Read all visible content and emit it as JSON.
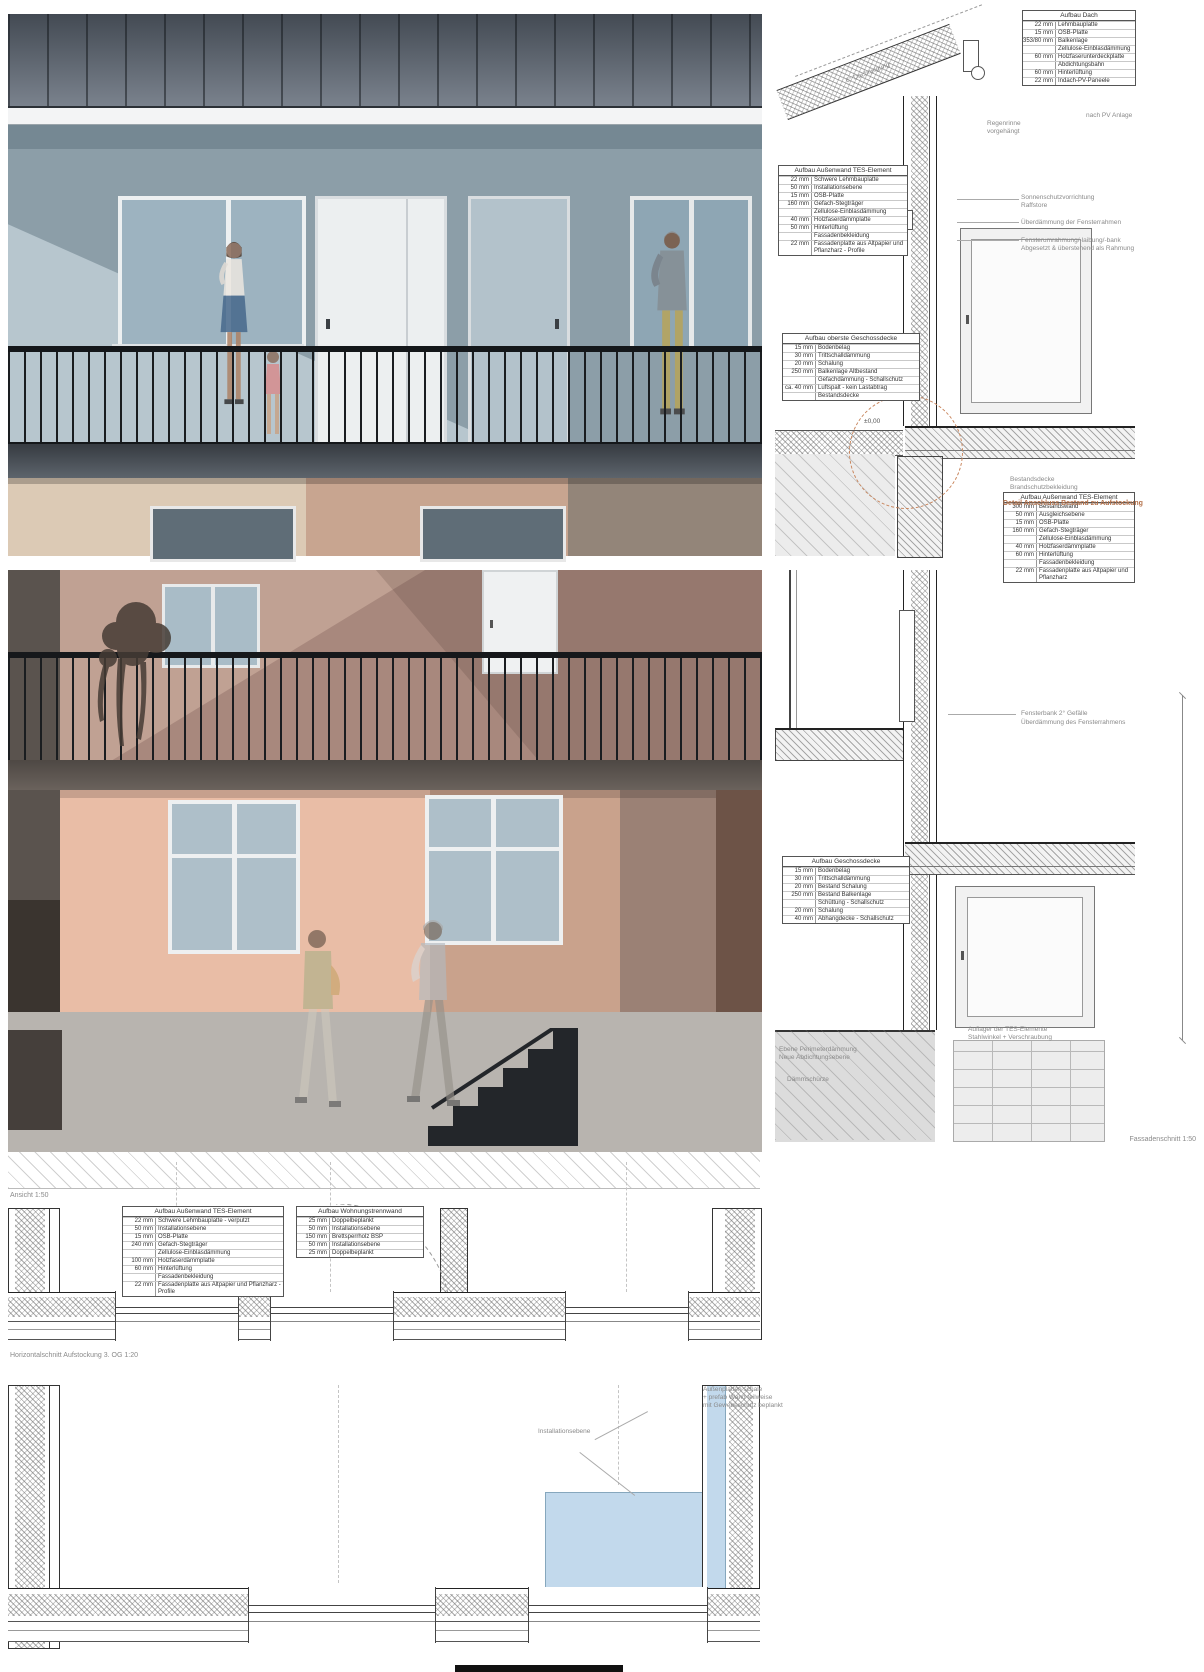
{
  "captions": {
    "ansicht": "Ansicht 1:50",
    "fassadenschnitt": "Fassadenschnitt 1:50",
    "horizontalschnitt": "Horizontalschnitt Aufstockung 3. OG 1:20"
  },
  "colors": {
    "accent_orange": "#c8855c",
    "plan_blue": "#c2d9ec",
    "facade_bluegrey": "#b7c6ce",
    "facade_mauve": "#a8887d",
    "facade_salmon": "#e9bda6"
  },
  "tables": {
    "dach": {
      "title": "Aufbau Dach",
      "rows": [
        [
          "22 mm",
          "Lehmbauplatte"
        ],
        [
          "15 mm",
          "OSB-Platte"
        ],
        [
          "353/80 mm",
          "Balkenlage"
        ],
        [
          "",
          "Zellulose-Einblasdämmung"
        ],
        [
          "60 mm",
          "Holzfaserunterdeckplatte"
        ],
        [
          "",
          "Abdichtungsbahn"
        ],
        [
          "60 mm",
          "Hinterlüftung"
        ],
        [
          "22 mm",
          "Indach-PV-Paneele"
        ]
      ]
    },
    "aussenwand_tes": {
      "title": "Aufbau Außenwand TES-Element",
      "rows": [
        [
          "22 mm",
          "Schwere Lehmbauplatte"
        ],
        [
          "50 mm",
          "Installationsebene"
        ],
        [
          "15 mm",
          "OSB-Platte"
        ],
        [
          "160 mm",
          "Gefach-Stegträger"
        ],
        [
          "",
          "Zellulose-Einblasdämmung"
        ],
        [
          "40 mm",
          "Holzfaserdämmplatte"
        ],
        [
          "50 mm",
          "Hinterlüftung"
        ],
        [
          "",
          "Fassadenbekleidung"
        ],
        [
          "22 mm",
          "Fassadenplatte aus Altpapier und Pflanzharz - Profile"
        ]
      ]
    },
    "oberste_decke": {
      "title": "Aufbau oberste Geschossdecke",
      "rows": [
        [
          "15 mm",
          "Bodenbelag"
        ],
        [
          "30 mm",
          "Trittschalldämmung"
        ],
        [
          "20 mm",
          "Schalung"
        ],
        [
          "250 mm",
          "Balkenlage Altbestand"
        ],
        [
          "",
          "Gefachdämmung - Schallschutz"
        ],
        [
          "ca. 40 mm",
          "Luftspalt - kein Lastabtrag"
        ],
        [
          "",
          "Bestandsdecke"
        ]
      ]
    },
    "aussenwand_bestand": {
      "title": "Aufbau Außenwand TES-Element",
      "rows": [
        [
          "300 mm",
          "Bestandswand"
        ],
        [
          "50 mm",
          "Ausgleichsebene"
        ],
        [
          "15 mm",
          "OSB-Platte"
        ],
        [
          "160 mm",
          "Gefach-Stegträger"
        ],
        [
          "",
          "Zellulose-Einblasdämmung"
        ],
        [
          "40 mm",
          "Holzfaserdämmplatte"
        ],
        [
          "60 mm",
          "Hinterlüftung"
        ],
        [
          "",
          "Fassadenbekleidung"
        ],
        [
          "22 mm",
          "Fassadenplatte aus Altpapier und Pflanzharz"
        ]
      ]
    },
    "geschossdecke": {
      "title": "Aufbau Geschossdecke",
      "rows": [
        [
          "15 mm",
          "Bodenbelag"
        ],
        [
          "30 mm",
          "Trittschalldämmung"
        ],
        [
          "20 mm",
          "Bestand Schalung"
        ],
        [
          "250 mm",
          "Bestand Balkenlage"
        ],
        [
          "",
          "Schüttung - Schallschutz"
        ],
        [
          "20 mm",
          "Schalung"
        ],
        [
          "40 mm",
          "Abhangdecke - Schallschutz"
        ]
      ]
    },
    "aussenwand_plan": {
      "title": "Aufbau Außenwand TES-Element",
      "rows": [
        [
          "22 mm",
          "Schwere Lehmbauplatte - verputzt"
        ],
        [
          "50 mm",
          "Installationsebene"
        ],
        [
          "15 mm",
          "OSB-Platte"
        ],
        [
          "240 mm",
          "Gefach-Stegträger"
        ],
        [
          "",
          "Zellulose-Einblasdämmung"
        ],
        [
          "100 mm",
          "Holzfaserdämmplatte"
        ],
        [
          "60 mm",
          "Hinterlüftung"
        ],
        [
          "",
          "Fassadenbekleidung"
        ],
        [
          "22 mm",
          "Fassadenplatte aus Altpapier und Pflanzharz - Profile"
        ]
      ]
    },
    "trennwand": {
      "title": "Aufbau Wohnungstrennwand",
      "rows": [
        [
          "25 mm",
          "Doppelbeplankt"
        ],
        [
          "50 mm",
          "Installationsebene"
        ],
        [
          "150 mm",
          "Brettsperrholz BSP"
        ],
        [
          "50 mm",
          "Installationsebene"
        ],
        [
          "25 mm",
          "Doppelbeplankt"
        ]
      ]
    }
  },
  "annotations": {
    "dachneigung": "6° Dachneigung",
    "nach_pv": "nach PV Anlage",
    "regenrinne1": "Regenrinne",
    "regenrinne2": "vorgehängt",
    "sonnenschutz1": "Sonnenschutzvorrichtung",
    "sonnenschutz2": "Raffstore",
    "ueberdaemmung": "Überdämmung der Fensterrahmen",
    "fensterrahmung1": "Fensterumrahmung/-laibung/-bank",
    "fensterrahmung2": "Abgesetzt & überstehend als Rahmung",
    "bestand1": "Bestandsdecke",
    "bestand2": "Brandschutzbekleidung",
    "detail": "Detail Anschluss Bestand zu Aufstockung",
    "level_zero": "±0,00",
    "fensterbank1": "Fensterbank 2° Gefälle",
    "fensterbank2": "Überdämmung des Fensterrahmens",
    "auflager1": "Auflager der TES-Elemente",
    "auflager2": "Stahlwinkel + Verschraubung",
    "perimeter1": "Ebene Perimeterdämmung",
    "perimeter2": "Neue Abdichtungsebene",
    "daemmschuerze": "Dämmschürze",
    "aussenplatten1": "Außenplatten schale",
    "aussenplatten2": "+ prefab Wand teilweise",
    "aussenplatten3": "mit Gewebeschutz beplankt",
    "installationsebene": "Installationsebene"
  }
}
